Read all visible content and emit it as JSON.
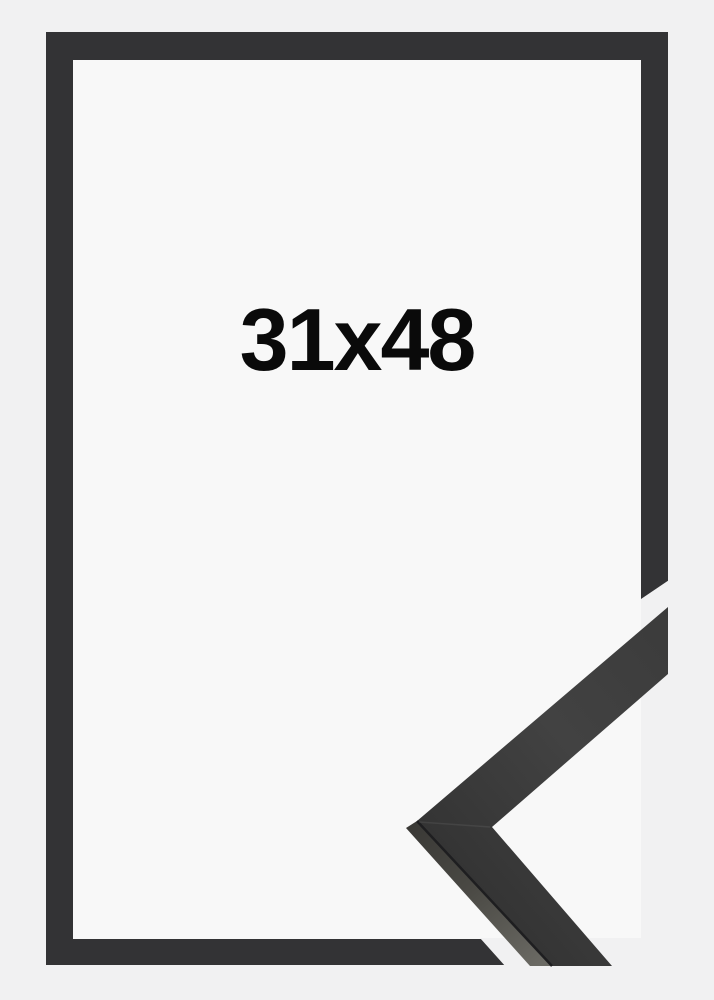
{
  "product": {
    "size_label": "31x48"
  },
  "scene": {
    "background": "#f1f1f2",
    "frame_color": "#333335",
    "opening_color": "#f8f8f8",
    "label_color": "#0a0a0a",
    "sample": {
      "face_dark": "#343434",
      "face_mid": "#424242",
      "face_light": "#3b3b3b",
      "underside_dark": "#3a3936",
      "underside_mid": "#4a4944",
      "underside_light": "#6b6a64",
      "seam": "#1e1e20",
      "miter_highlight": "rgba(255,255,255,0.07)"
    }
  }
}
